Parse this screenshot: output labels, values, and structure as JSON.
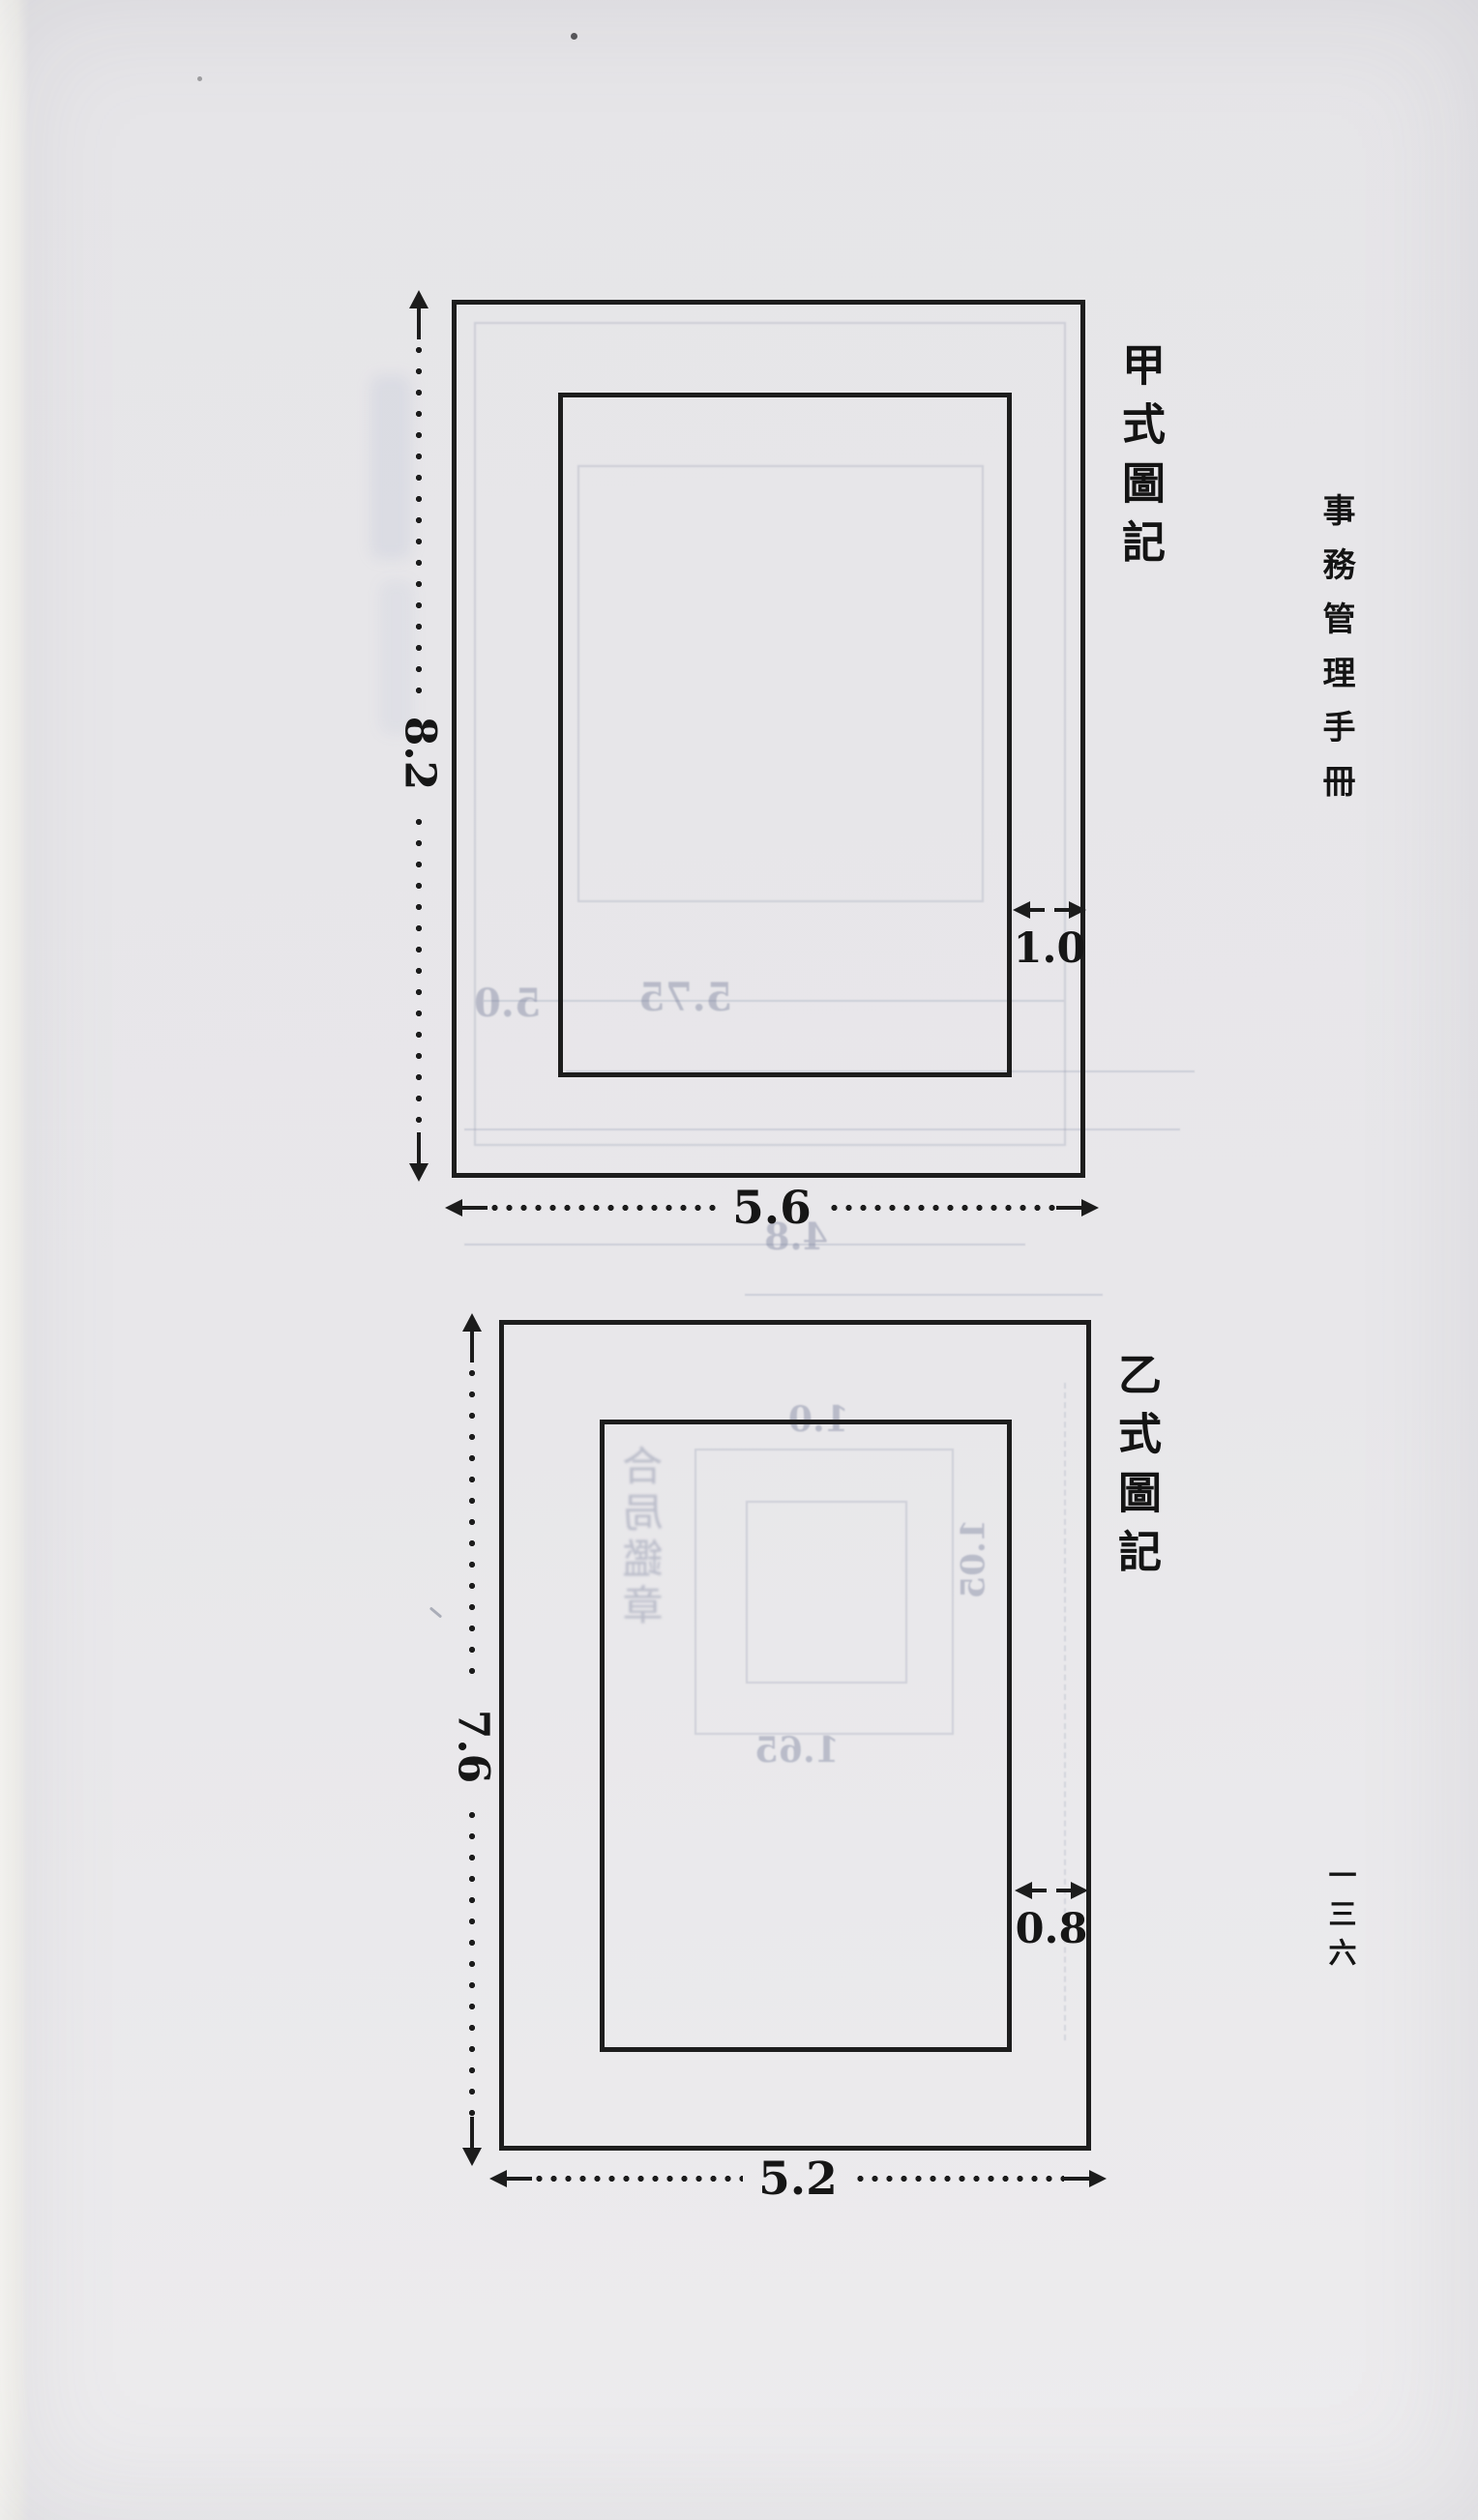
{
  "page": {
    "book_title_vertical": "事務管理手冊",
    "page_number_vertical": "一三六",
    "ink_color": "#1d1d1d",
    "paper_color": "#e8e7ea"
  },
  "diagram_a": {
    "title": "甲式圖記",
    "height_dim": "8.2",
    "width_dim": "5.6",
    "gap_dim": "1.0"
  },
  "diagram_b": {
    "title": "乙式圖記",
    "height_dim": "7.6",
    "width_dim": "5.2",
    "gap_dim": "0.8"
  },
  "bleedthrough": {
    "dim_left": "5.0",
    "dim_mid": "5.75",
    "dim_between": "4.8",
    "dim_b_top": "1.0",
    "dim_b_bottom": "1.65",
    "dim_b_right": "1.05",
    "seal_text": "合局鑑章"
  }
}
